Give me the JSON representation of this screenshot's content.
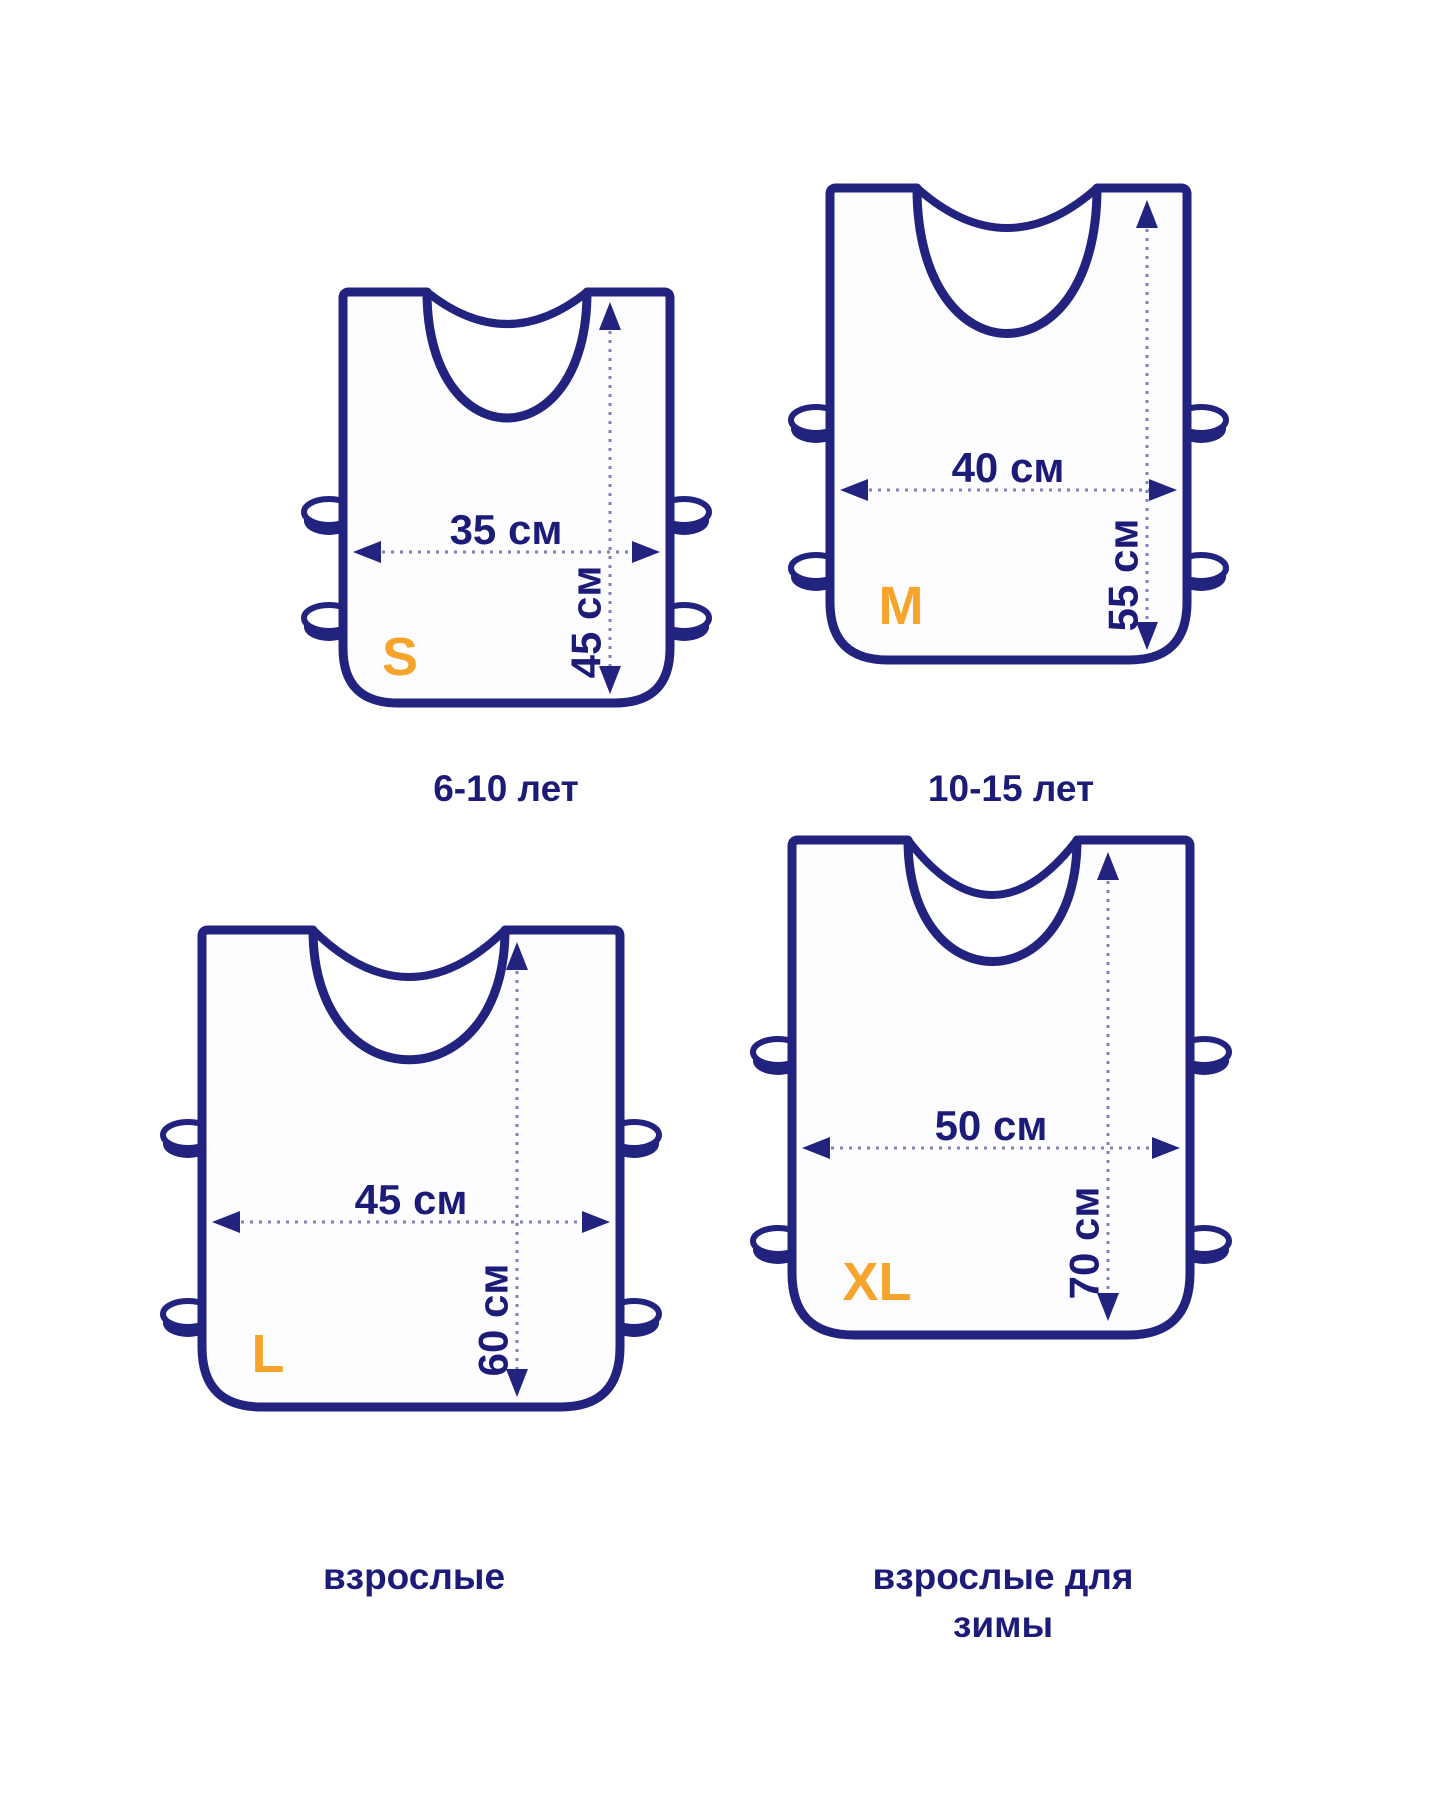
{
  "diagram": {
    "type": "vest-size-chart",
    "unit": "см",
    "colors": {
      "outline_navy": "#22227f",
      "text_navy": "#1c1c78",
      "accent_orange": "#f7a42c",
      "dimension_line": "#7d82bb",
      "background": "#ffffff"
    },
    "vests": [
      {
        "size_letter": "S",
        "width_label": "35 см",
        "height_label": "45 см",
        "width_cm": 35,
        "height_cm": 45,
        "caption": "6-10 лет"
      },
      {
        "size_letter": "M",
        "width_label": "40 см",
        "height_label": "55 см",
        "width_cm": 40,
        "height_cm": 55,
        "caption": "10-15 лет"
      },
      {
        "size_letter": "L",
        "width_label": "45 см",
        "height_label": "60 см",
        "width_cm": 45,
        "height_cm": 60,
        "caption": "взрослые"
      },
      {
        "size_letter": "XL",
        "width_label": "50 см",
        "height_label": "70 см",
        "width_cm": 50,
        "height_cm": 70,
        "caption": "взрослые для зимы",
        "caption_lines": [
          "взрослые для",
          "зимы"
        ]
      }
    ]
  }
}
